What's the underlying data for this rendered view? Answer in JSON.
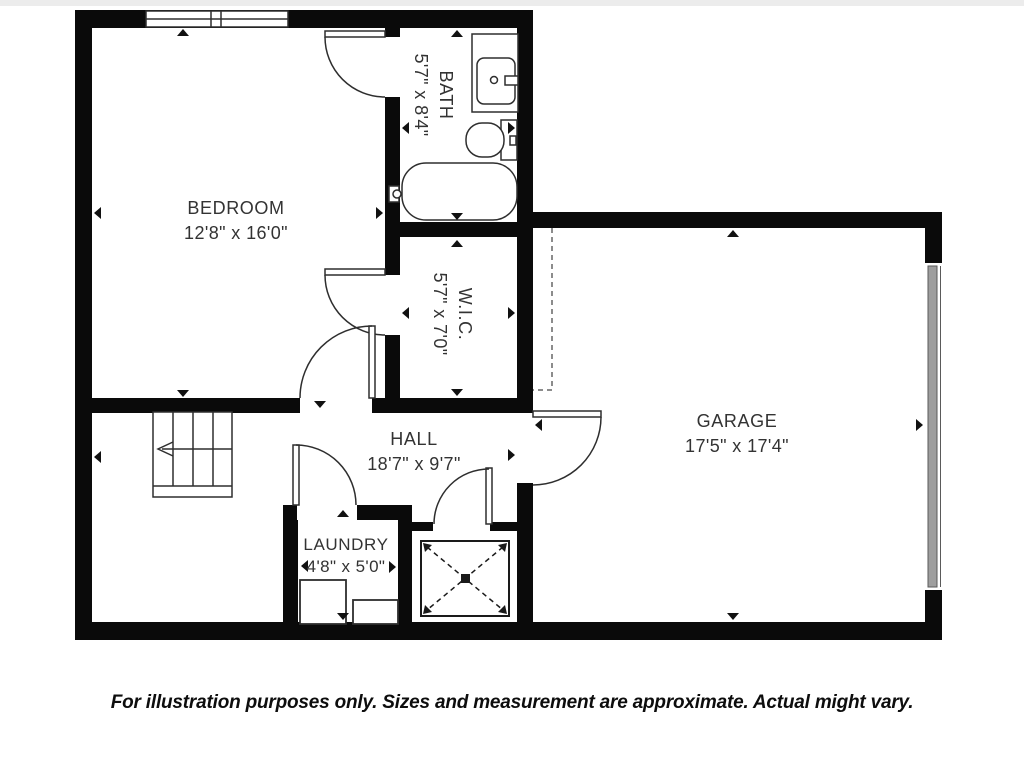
{
  "plan_title": "Basement / garage level floor plan",
  "rooms": [
    {
      "id": "bedroom",
      "name": "BEDROOM",
      "dims": "12'8\" x 16'0\""
    },
    {
      "id": "bath",
      "name": "BATH",
      "dims": "5'7\" x 8'4\""
    },
    {
      "id": "wic",
      "name": "W.I.C.",
      "dims": "5'7\" x 7'0\""
    },
    {
      "id": "garage",
      "name": "GARAGE",
      "dims": "17'5\" x 17'4\""
    },
    {
      "id": "hall",
      "name": "HALL",
      "dims": "18'7\" x 9'7\""
    },
    {
      "id": "laundry",
      "name": "LAUNDRY",
      "dims": "4'8\" x 5'0\""
    }
  ],
  "disclaimer": "For illustration purposes only. Sizes and measurement are approximate. Actual might vary.",
  "colors": {
    "wall": "#0a0a0a",
    "fixture_line": "#2e2e2e",
    "garage_door_fill": "#9e9e9e",
    "background": "#ffffff",
    "label_text": "#333333",
    "disclaimer_text": "#0d0d0d"
  },
  "fixtures": [
    "double-window",
    "staircase-with-arrow",
    "bathtub",
    "toilet",
    "vanity-sink",
    "washer",
    "dryer",
    "mechanical-shaft-x",
    "garage-door",
    "door-swings",
    "dimension-markers"
  ]
}
